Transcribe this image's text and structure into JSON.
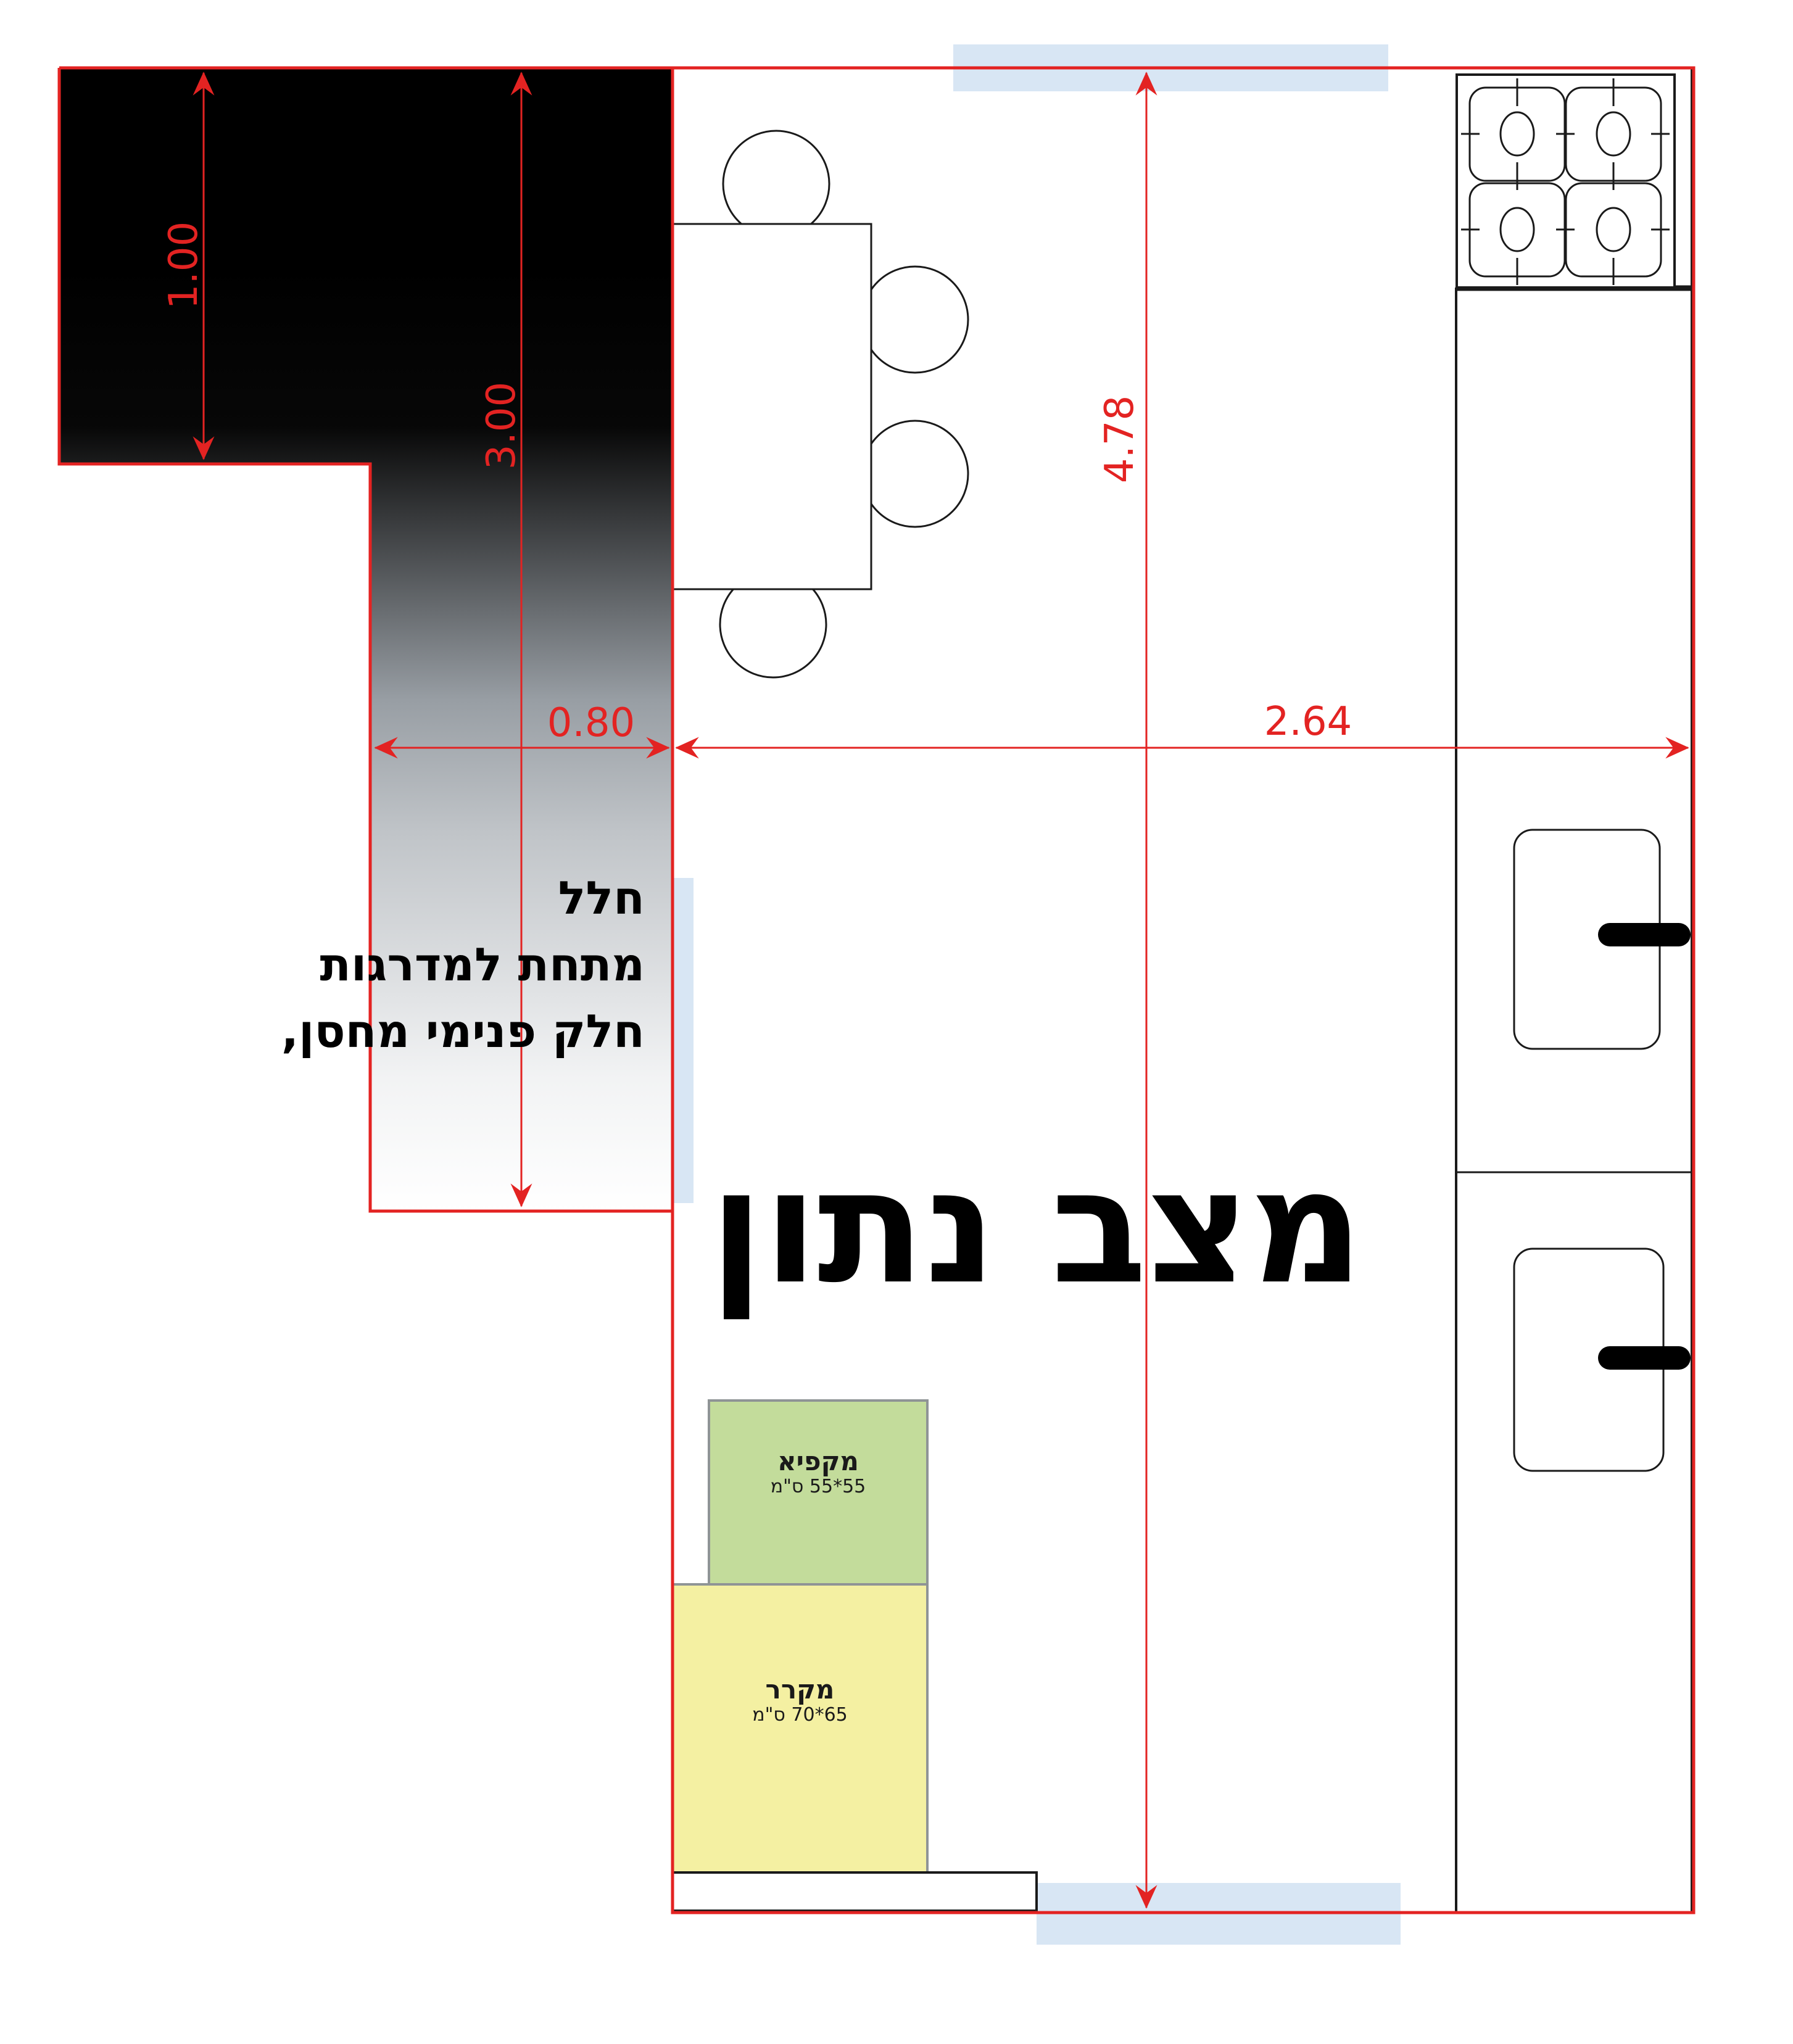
{
  "title": "מצב נתון",
  "note": {
    "line1": "חלל",
    "line2": "מתחת למדרגות",
    "line3": "חלק פנימי מחסן,"
  },
  "dimensions": {
    "stair_top_depth": "1.00",
    "stair_total_height": "3.00",
    "stair_column_width": "0.80",
    "kitchen_width": "2.64",
    "kitchen_height": "4.78"
  },
  "appliances": {
    "freezer": {
      "name": "מקפיא",
      "size": "55*55 ס\"מ"
    },
    "fridge": {
      "name": "מקרר",
      "size": "65*70 ס\"מ"
    }
  },
  "colors": {
    "dimension_red": "#e32322",
    "window_blue": "#d8e6f4",
    "freezer_green": "#c3dc9b",
    "fridge_yellow": "#f4f0a2",
    "box_border_gray": "#8f9496",
    "line_black": "#1a1a1a"
  }
}
